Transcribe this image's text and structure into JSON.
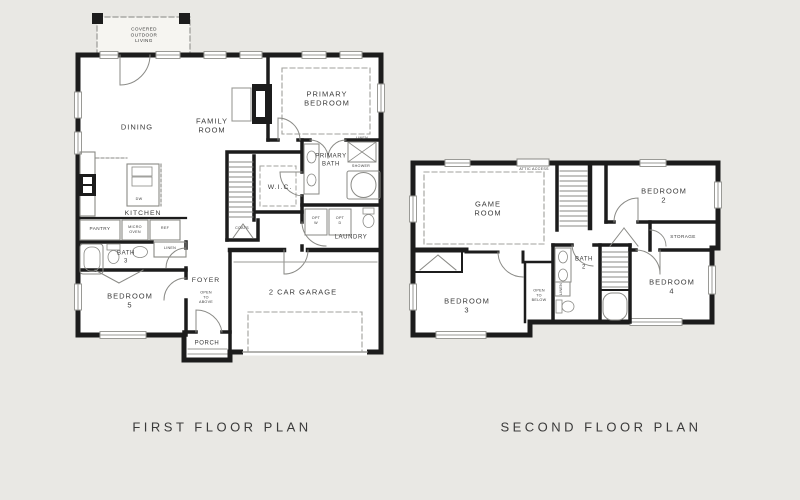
{
  "colors": {
    "background": "#e9e8e4",
    "wall": "#1c1c1c",
    "thin_line": "#9a9a96",
    "text": "#3b3b3b"
  },
  "first_floor": {
    "caption": "FIRST FLOOR PLAN",
    "labels": {
      "covered_outdoor_living": "COVERED\nOUTDOOR\nLIVING",
      "dining": "DINING",
      "family_room": "FAMILY\nROOM",
      "primary_bedroom": "PRIMARY\nBEDROOM",
      "primary_bath": "PRIMARY\nBATH",
      "linen_closet": "LINEN",
      "shower": "SHOWER",
      "wic": "W.I.C.",
      "kitchen": "KITCHEN",
      "dishwasher": "DW",
      "pantry": "PANTRY",
      "micro_oven": "MICRO\nOVEN",
      "refrigerator": "REF",
      "linen_hall": "LINEN",
      "bath_3": "BATH\n3",
      "bedroom_5": "BEDROOM\n5",
      "coats": "COATS",
      "foyer": "FOYER",
      "open_to_above": "OPEN\nTO\nABOVE",
      "laundry": "LAUNDRY",
      "opt_washer": "OPT\nW",
      "opt_dryer": "OPT\nD",
      "garage": "2 CAR GARAGE",
      "porch": "PORCH"
    }
  },
  "second_floor": {
    "caption": "SECOND FLOOR PLAN",
    "labels": {
      "game_room": "GAME\nROOM",
      "attic_access": "ATTIC ACCESS",
      "bedroom_2": "BEDROOM\n2",
      "storage": "STORAGE",
      "bedroom_4": "BEDROOM\n4",
      "bath_2": "BATH\n2",
      "linen": "LINEN",
      "bedroom_3": "BEDROOM\n3",
      "open_to_below": "OPEN\nTO\nBELOW"
    }
  }
}
